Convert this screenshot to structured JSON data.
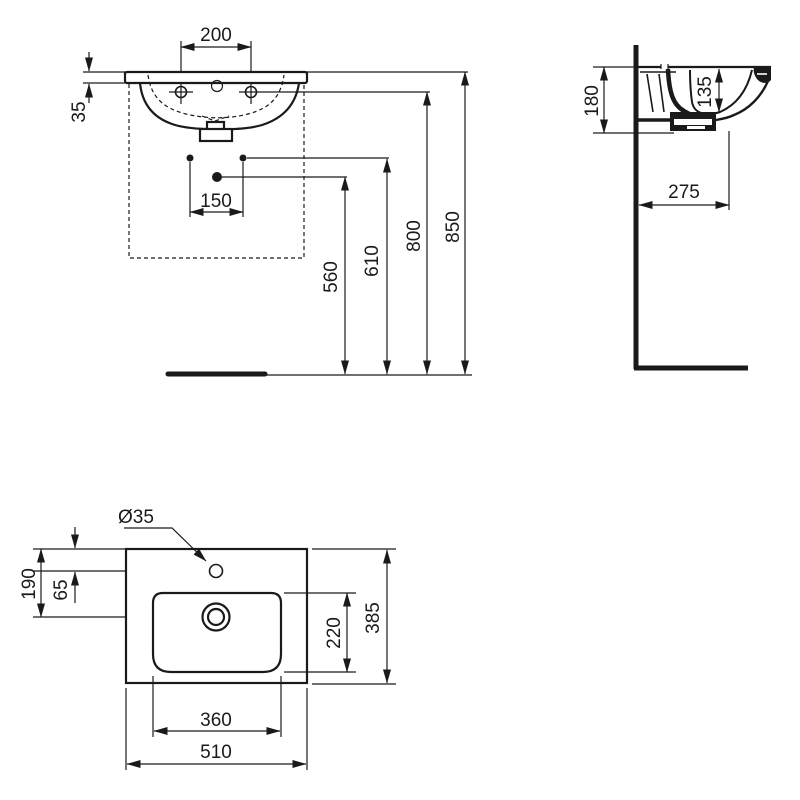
{
  "drawing": {
    "front_view": {
      "tap_hole_spacing": "200",
      "rim_thickness": "35",
      "fixing_hole_spacing": "150",
      "waste_outlet_height": "560",
      "fixing_holes_height": "610",
      "tap_holes_height": "800",
      "rim_height": "850"
    },
    "side_view": {
      "overall_depth": "180",
      "bowl_depth": "135",
      "waste_from_wall": "275"
    },
    "plan_view": {
      "tap_hole_diameter": "Ø35",
      "waste_from_back": "190",
      "tap_hole_from_back": "65",
      "bowl_depth": "220",
      "overall_depth": "385",
      "bowl_width": "360",
      "overall_width": "510"
    }
  }
}
